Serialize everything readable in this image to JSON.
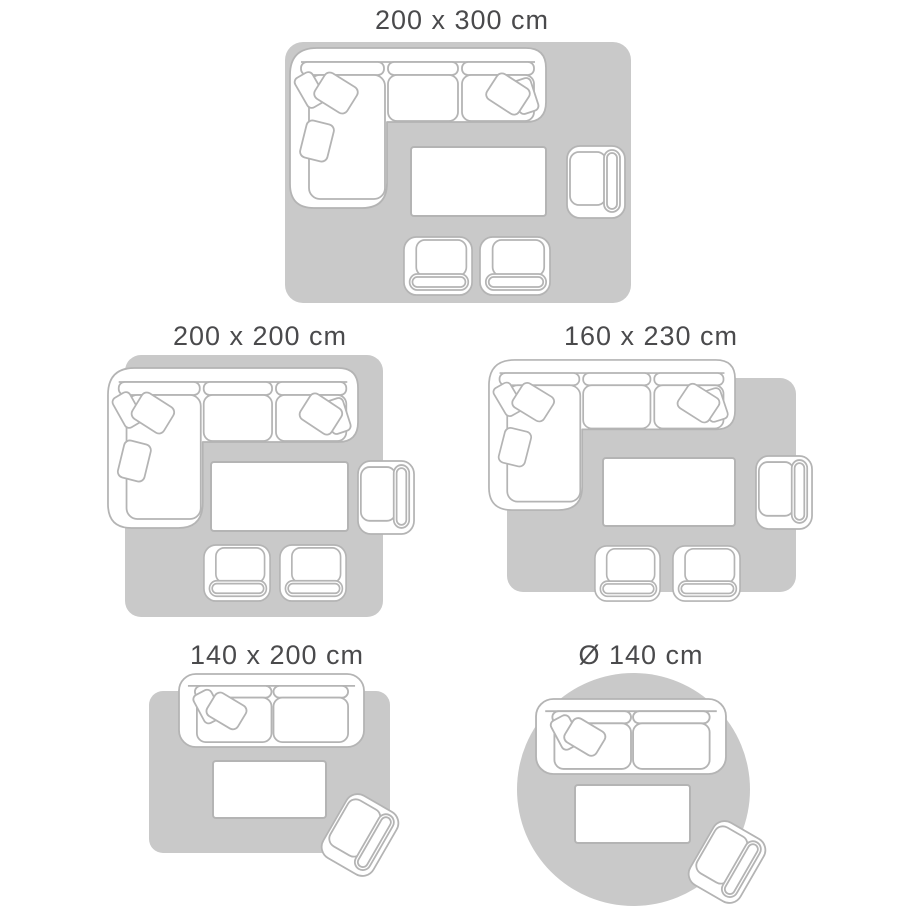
{
  "guide": {
    "layouts": [
      {
        "label": "200 x 300 cm",
        "rug_shape": "rectangle",
        "furniture": [
          "corner-sofa",
          "coffee-table",
          "armchair",
          "footstool",
          "footstool"
        ]
      },
      {
        "label": "200 x 200 cm",
        "rug_shape": "rectangle",
        "furniture": [
          "corner-sofa",
          "coffee-table",
          "armchair",
          "footstool",
          "footstool"
        ]
      },
      {
        "label": "160 x 230 cm",
        "rug_shape": "rectangle",
        "furniture": [
          "corner-sofa",
          "coffee-table",
          "armchair",
          "footstool",
          "footstool"
        ]
      },
      {
        "label": "140 x 200 cm",
        "rug_shape": "rectangle",
        "furniture": [
          "sofa",
          "coffee-table",
          "armchair"
        ]
      },
      {
        "label": "Ø 140 cm",
        "rug_shape": "circle",
        "furniture": [
          "sofa",
          "coffee-table",
          "armchair"
        ]
      }
    ],
    "colors": {
      "background": "#ffffff",
      "rug_fill": "#c9c9c9",
      "furniture_outline": "#b4b4b4",
      "furniture_fill": "#ffffff",
      "label_text": "#4a4a4c"
    }
  }
}
